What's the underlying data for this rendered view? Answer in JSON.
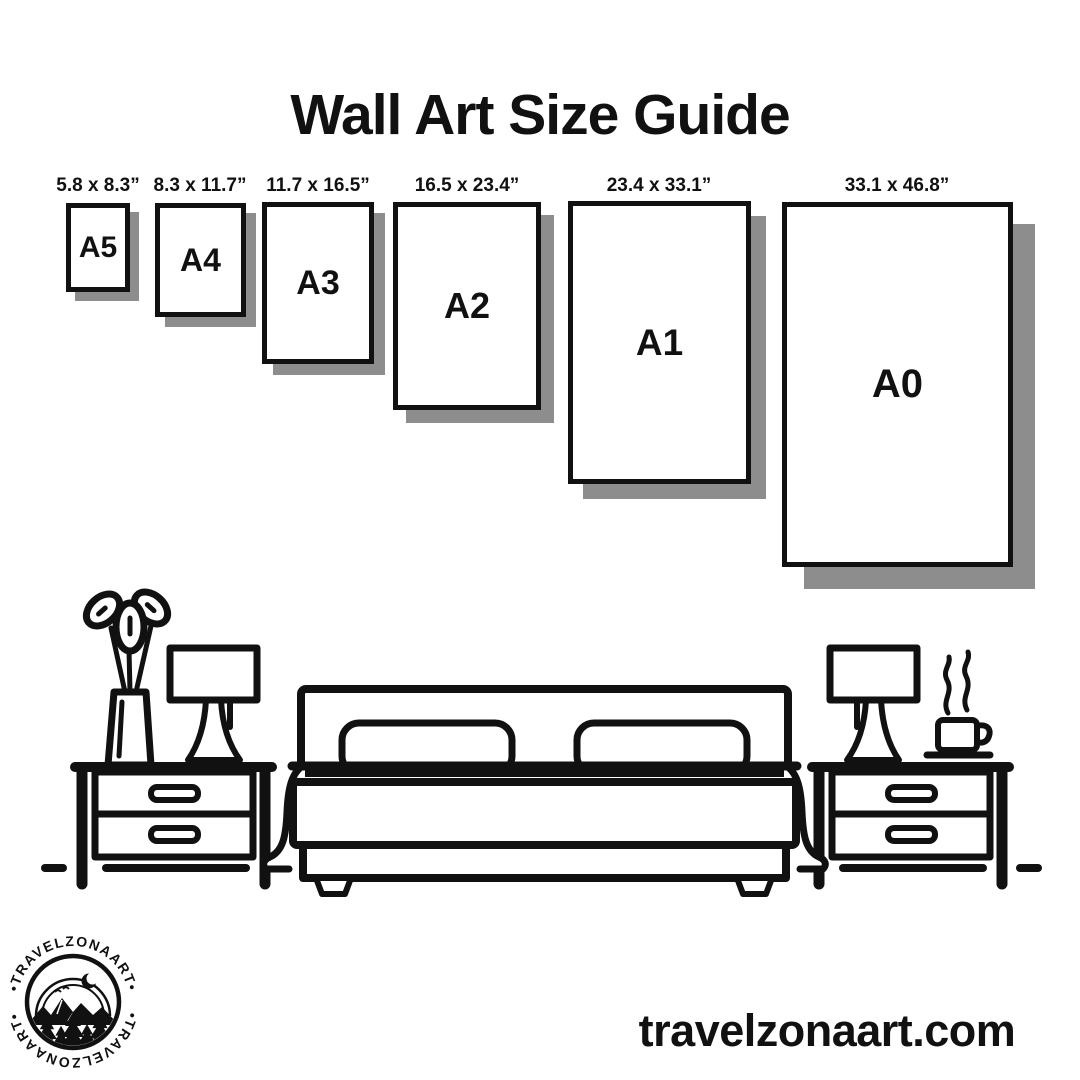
{
  "title": "Wall Art Size Guide",
  "sizes": [
    {
      "label": "A5",
      "dims": "5.8 x 8.3”"
    },
    {
      "label": "A4",
      "dims": "8.3 x 11.7”"
    },
    {
      "label": "A3",
      "dims": "11.7 x 16.5”"
    },
    {
      "label": "A2",
      "dims": "16.5 x 23.4”"
    },
    {
      "label": "A1",
      "dims": "23.4 x 33.1”"
    },
    {
      "label": "A0",
      "dims": "33.1 x 46.8”"
    }
  ],
  "footer": {
    "website": "travelzonaart.com",
    "logo_text": "•TRAVELZONAART•"
  },
  "colors": {
    "ink": "#111111",
    "shadow": "#8d8d8d",
    "background": "#ffffff"
  },
  "icons": [
    "flower-vase",
    "table-lamp",
    "nightstand",
    "double-bed",
    "coffee-mug",
    "floor-dash",
    "mountain-badge"
  ]
}
